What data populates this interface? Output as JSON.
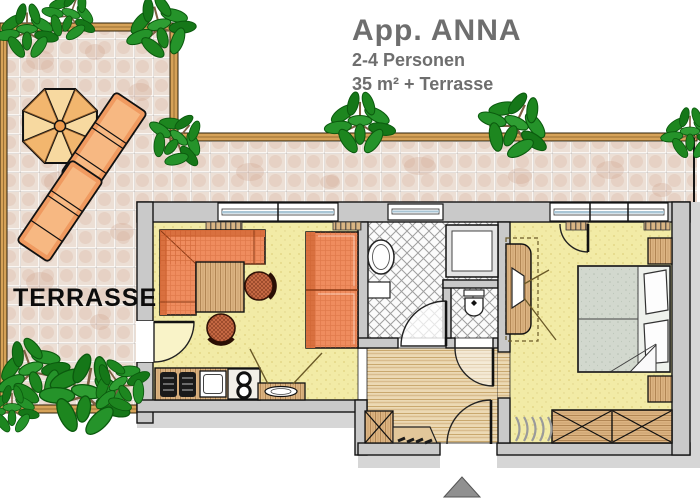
{
  "header": {
    "app_name": "App. ANNA",
    "capacity": "2-4 Personen",
    "size": "35 m² + Terrasse"
  },
  "terrace": {
    "label": "TERRASSE"
  },
  "colors": {
    "title_gray": "#6e6e6e",
    "label_black": "#0c0c0c",
    "wall_gray": "#c9c9c9",
    "shadow_gray": "#d6d6d6",
    "terrace_tile": "#ecdfd5",
    "rail_wood": "#d6a258",
    "floor_yellow": "#f2eba6",
    "hall_plank": "#ecd9b4",
    "furniture_wood": "#dcb482",
    "upholstery_orange": "#ef8c5e",
    "plant_green": "#1d861f",
    "bed_mattress": "#d2d8ce",
    "window_glass": "#a9c6d6",
    "entrance_marker": "#909090"
  }
}
